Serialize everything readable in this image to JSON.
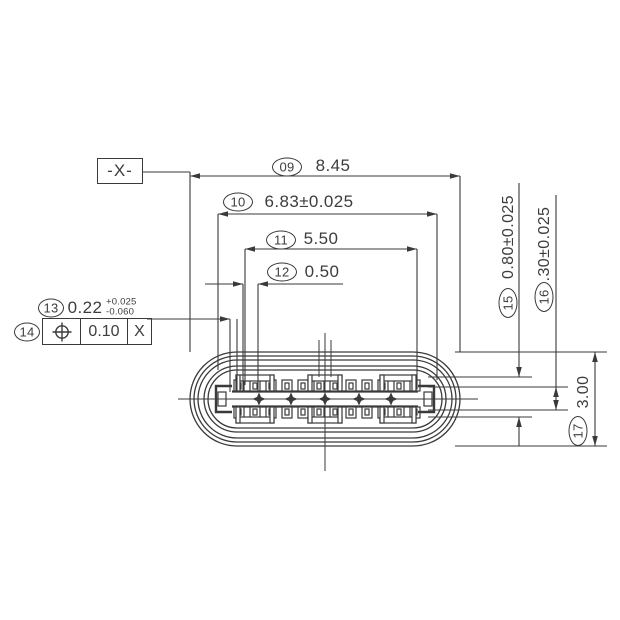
{
  "drawing": {
    "title_context": "USB Type-C connector front-view dimension drawing",
    "datum_label": "-X-",
    "colors": {
      "line": "#3a3a3a",
      "text": "#3d3d3d",
      "background": "#ffffff"
    },
    "dims": {
      "d09": {
        "balloon": "09",
        "value": "8.45"
      },
      "d10": {
        "balloon": "10",
        "value": "6.83±0.025"
      },
      "d11": {
        "balloon": "11",
        "value": "5.50"
      },
      "d12": {
        "balloon": "12",
        "value": "0.50"
      },
      "d13": {
        "balloon": "13",
        "value": "0.22",
        "tol_plus": "+0.025",
        "tol_minus": "-0.060"
      },
      "d14": {
        "balloon": "14",
        "tolerance": "0.10",
        "datum_ref": "X",
        "symbol": "position-tolerance"
      },
      "d15": {
        "balloon": "15",
        "value": "0.80±0.025"
      },
      "d16": {
        "balloon": "16",
        "value": ".30±0.025"
      },
      "d17": {
        "balloon": "17",
        "value": "3.00"
      }
    }
  }
}
